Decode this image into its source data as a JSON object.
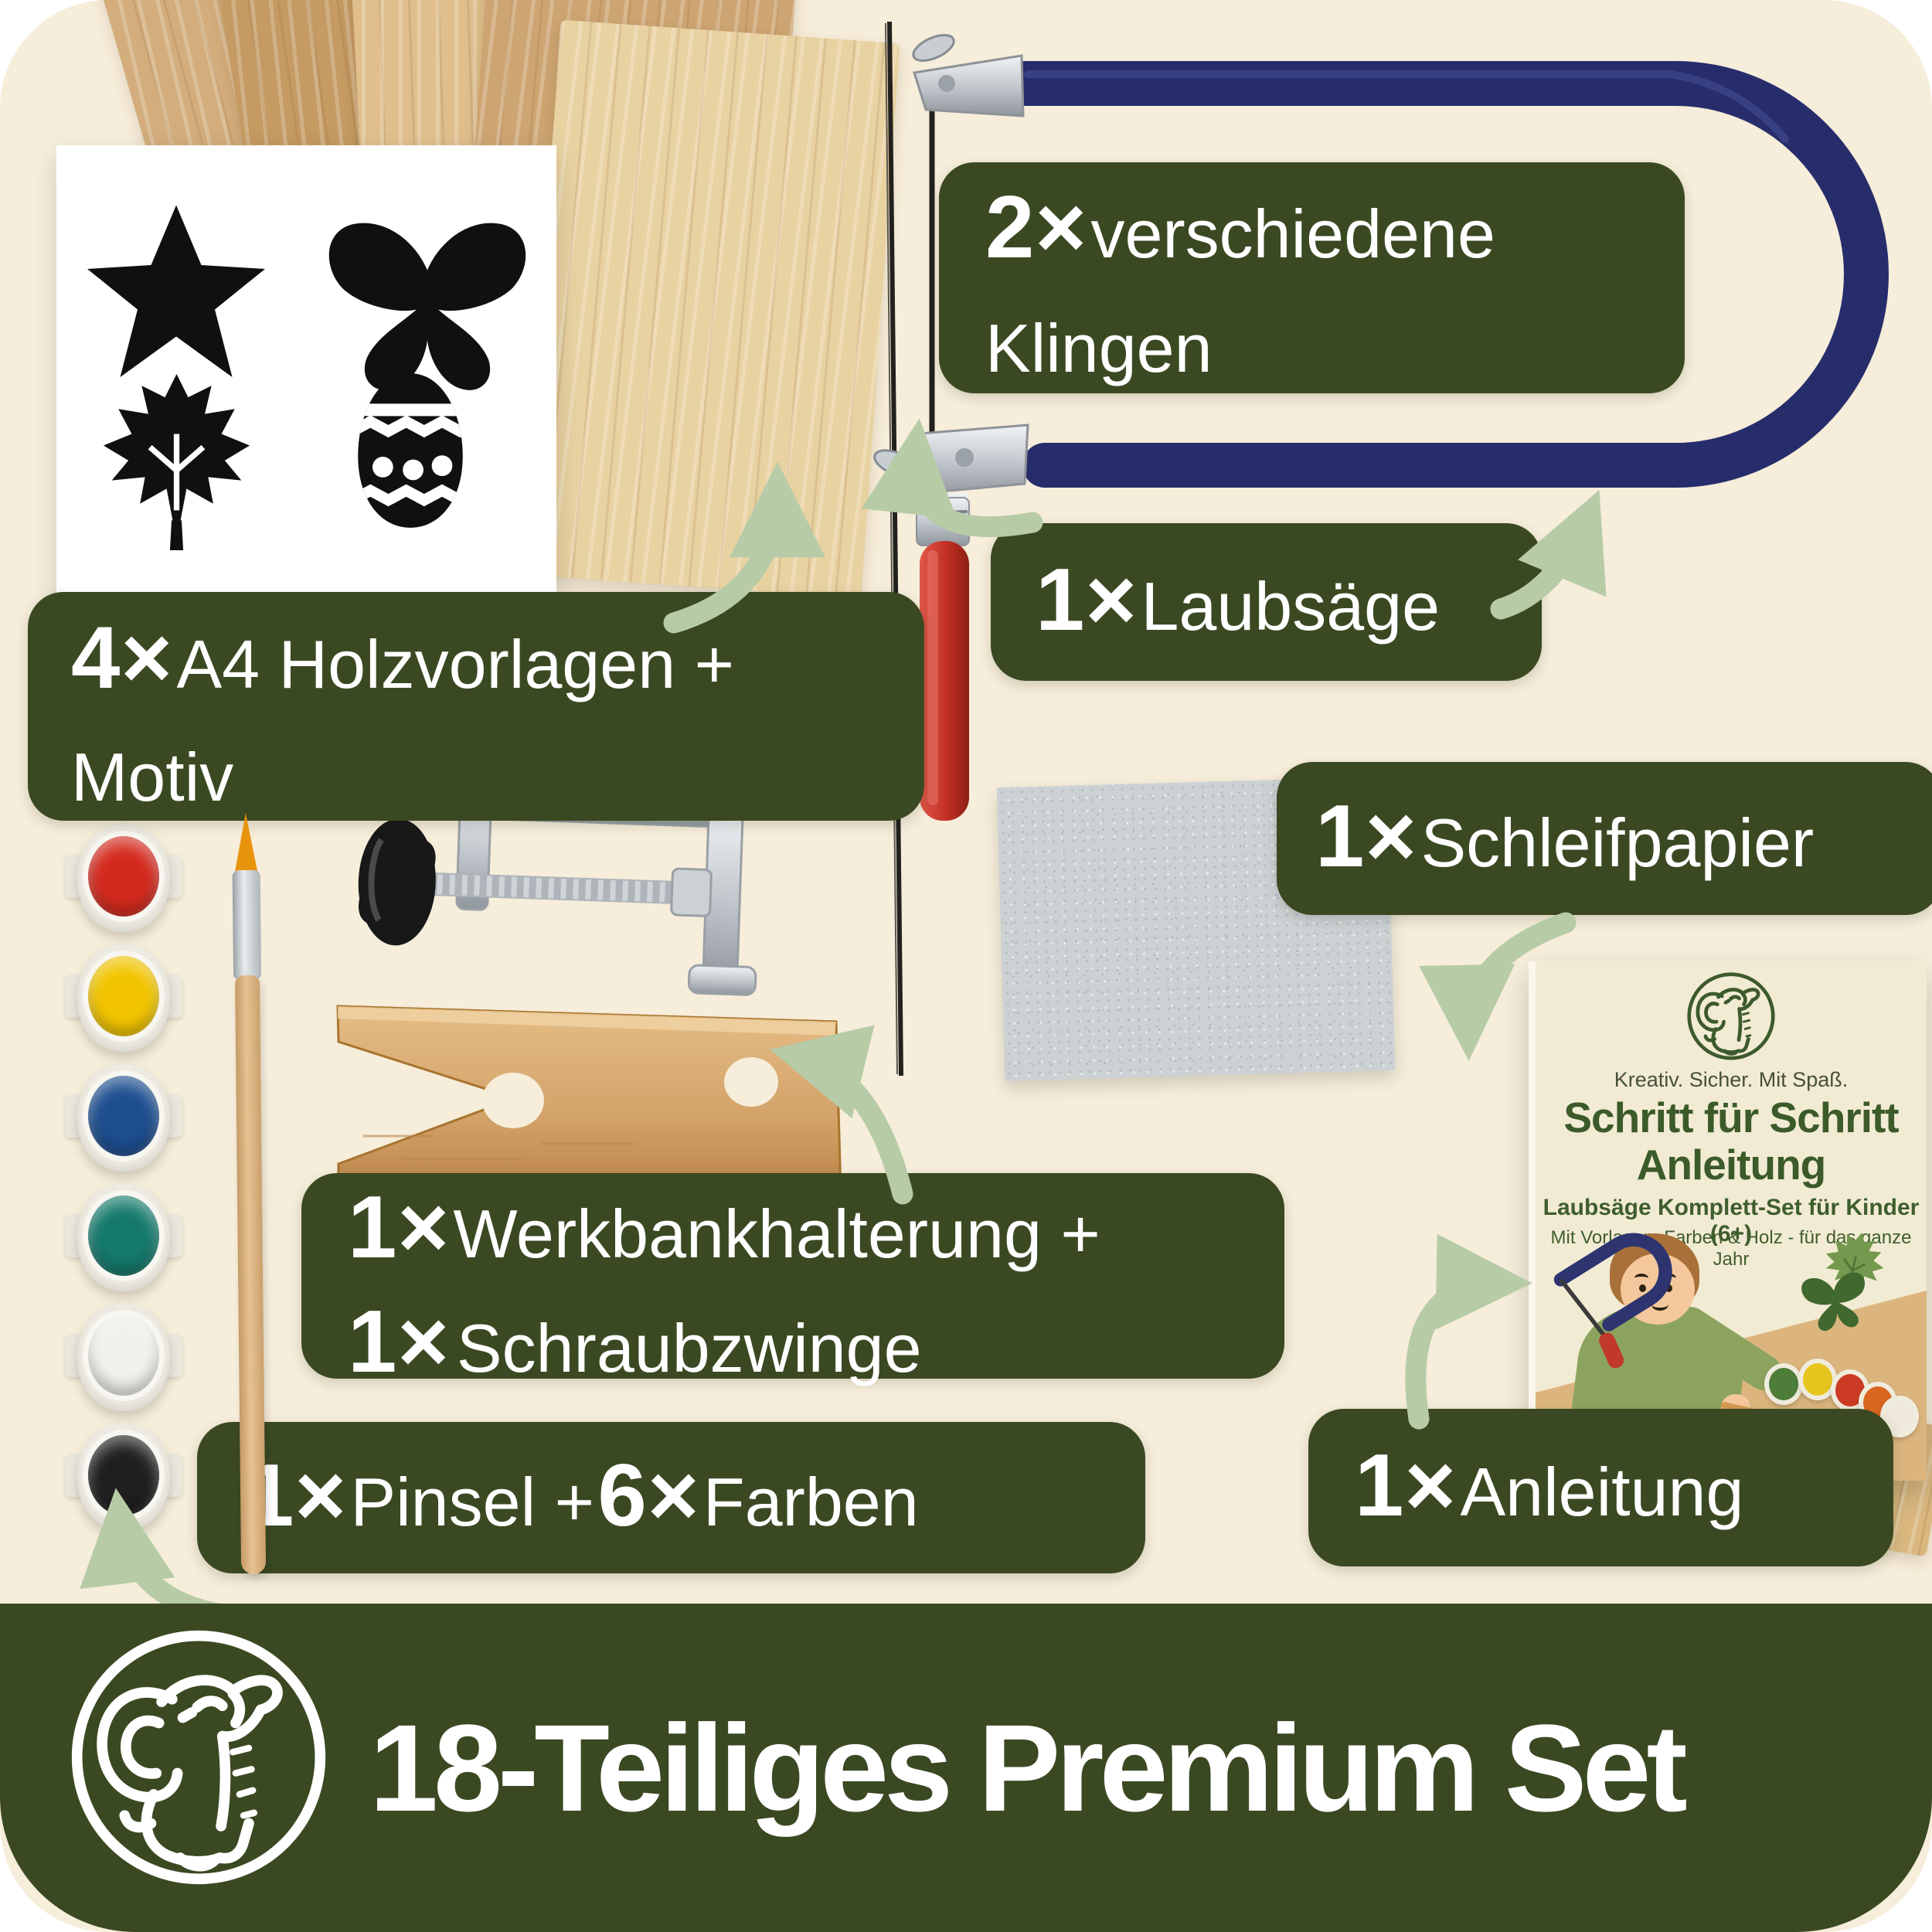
{
  "theme": {
    "page_bg": "#ffffff",
    "panel_bg": "#f6edda",
    "label_bg": "#3b4923",
    "label_text": "#ffffff",
    "arrow_color": "#b7cba7",
    "saw_frame_navy": "#272d6b",
    "handle_red": "#c22f24",
    "banner_bg": "#3b4923"
  },
  "labels": {
    "wood": {
      "qty": "4×",
      "line1": "A4 Holzvorlagen +",
      "line2": "Motiv"
    },
    "blades": {
      "qty": "2×",
      "line1": "verschiedene",
      "line2": "Klingen"
    },
    "saw": {
      "qty": "1×",
      "text": "Laubsäge"
    },
    "sandpaper": {
      "qty": "1×",
      "text": "Schleifpapier"
    },
    "bench": {
      "qty1": "1×",
      "line1": "Werkbankhalterung +",
      "qty2": "1×",
      "line2": "Schraubzwinge"
    },
    "paint": {
      "qty1": "1×",
      "text1": "Pinsel +",
      "qty2": "6×",
      "text2": "Farben"
    },
    "manual": {
      "qty": "1×",
      "text": "Anleitung"
    }
  },
  "booklet": {
    "tagline": "Kreativ. Sicher. Mit Spaß.",
    "title_line1": "Schritt für Schritt",
    "title_line2": "Anleitung",
    "subtitle1": "Laubsäge Komplett-Set für Kinder (6+)",
    "subtitle2": "Mit Vorlagen, Farben & Holz - für das ganze Jahr"
  },
  "banner": {
    "title": "18-Teiliges Premium Set"
  },
  "paints": {
    "colors": [
      "#d42a1e",
      "#f2c500",
      "#1d4e8f",
      "#15796b",
      "#f1f0ea",
      "#1f1f1f"
    ]
  }
}
